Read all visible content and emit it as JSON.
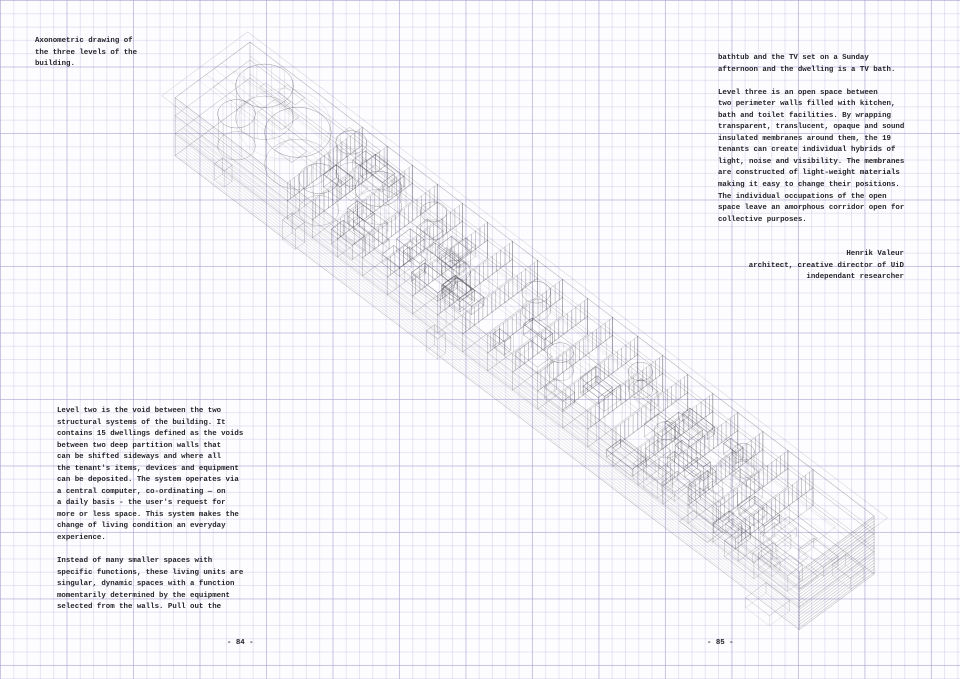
{
  "page": {
    "left_page_number": "- 84 -",
    "right_page_number": "- 85 -"
  },
  "caption": {
    "lines": [
      "Axonometric drawing of",
      "the three levels of the",
      "building."
    ]
  },
  "right_column": {
    "lines": [
      "bathtub and the TV set on a Sunday",
      "afternoon and the dwelling is a TV bath.",
      "",
      "Level three is an open space between",
      "two perimeter walls filled with kitchen,",
      "bath and toilet facilities. By wrapping",
      "transparent, translucent, opaque and sound",
      "insulated membranes around them, the 19",
      "tenants can create individual hybrids of",
      "light, noise and visibility. The membranes",
      "are constructed of light-weight materials",
      "making it easy to change their positions.",
      "The individual occupations of the open",
      "space leave an amorphous corridor open for",
      "collective purposes."
    ],
    "attribution_lines": [
      "Henrik Valeur",
      "architect, creative director of UiD",
      "independant researcher"
    ]
  },
  "left_column": {
    "lines": [
      "Level two is the void between the two",
      "structural systems of the building. It",
      "contains 15 dwellings defined as the voids",
      "between two deep partition walls that",
      "can be shifted sideways and where all",
      "the tenant's items, devices and equipment",
      "can be deposited. The system operates via",
      "a central computer, co-ordinating — on",
      "a daily basis - the user's request for",
      "more or less space. This system makes the",
      "change of living condition an everyday",
      "experience.",
      "",
      "Instead of many smaller spaces with",
      "specific functions, these living units are",
      "singular, dynamic spaces with a function",
      "momentarily determined by the equipment",
      "selected from the walls. Pull out the"
    ]
  },
  "colors": {
    "paper": "#fdfdff",
    "grid_line": "#d9d4ea",
    "text_ink": "#23232a",
    "wire_ink": "#3b3b46"
  },
  "drawing": {
    "name": "axonometric-wireframe",
    "levels": 3,
    "ink": "#3b3b46",
    "x0": 250,
    "y0": 100,
    "ux": 0.79,
    "uy": 0.6,
    "vx": -0.78,
    "vy": 0.58,
    "length": 790,
    "width": 96,
    "roof_h": 58,
    "mid_h": 40,
    "floor_h": 22,
    "partition_count": 19,
    "partition_start": 142,
    "partition_step": 31.7,
    "cylinders": [
      [
        46,
        28,
        26
      ],
      [
        52,
        70,
        17
      ],
      [
        106,
        46,
        30
      ],
      [
        148,
        20,
        14
      ],
      [
        158,
        72,
        18
      ],
      [
        204,
        42,
        21
      ],
      [
        258,
        26,
        12
      ],
      [
        322,
        62,
        13
      ],
      [
        390,
        28,
        13
      ],
      [
        456,
        64,
        12
      ],
      [
        522,
        28,
        11
      ],
      [
        588,
        62,
        11
      ],
      [
        654,
        30,
        10
      ]
    ],
    "furniture_count": 44,
    "slab_box_count": 18,
    "seed": 7
  }
}
